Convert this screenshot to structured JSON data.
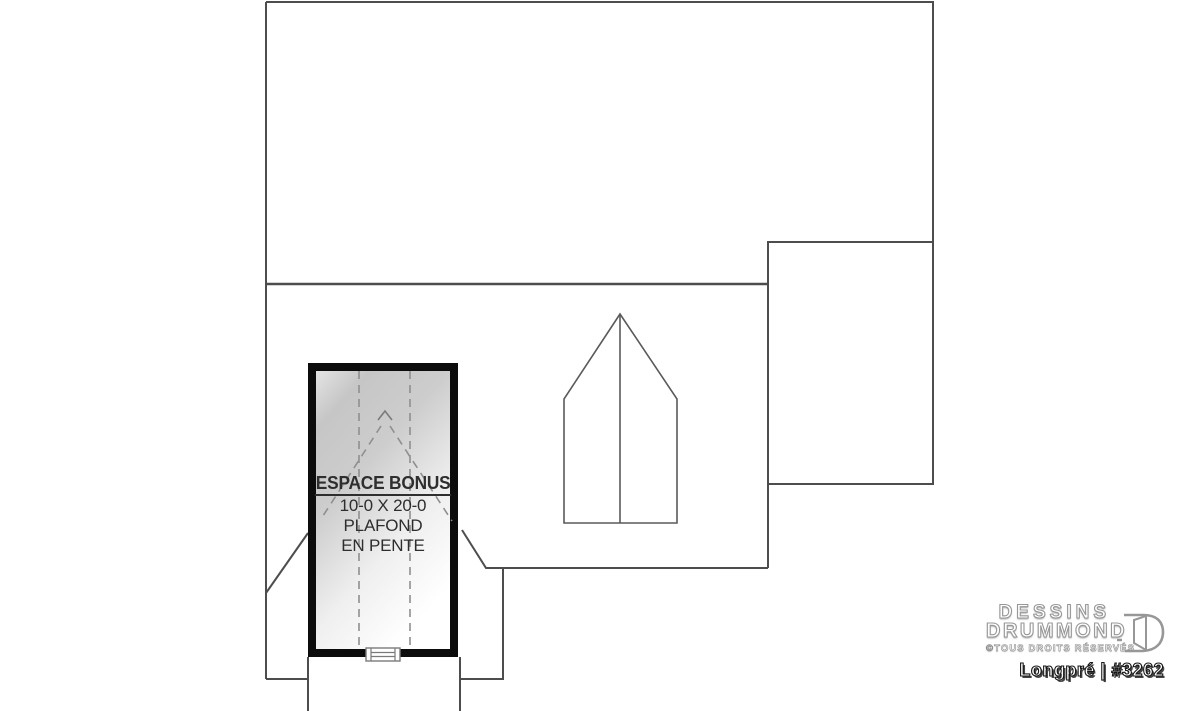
{
  "plan": {
    "bonus_room": {
      "title": "ESPACE BONUS",
      "dimensions": "10-0 X 20-0",
      "note_lines": [
        "PLAFOND",
        "EN PENTE"
      ]
    },
    "colors": {
      "wall_line": "#4d4d4d",
      "thin_line": "#5a5a5a",
      "dashed_line": "#8f8f8f",
      "room_border": "#0c0c0c",
      "text": "#2e2e2e"
    }
  },
  "branding": {
    "name_line1": "DESSINS",
    "name_line2": "DRUMMOND",
    "rights": "©TOUS DROITS RÉSERVÉS",
    "plan_label": "Longpré | #3262"
  }
}
